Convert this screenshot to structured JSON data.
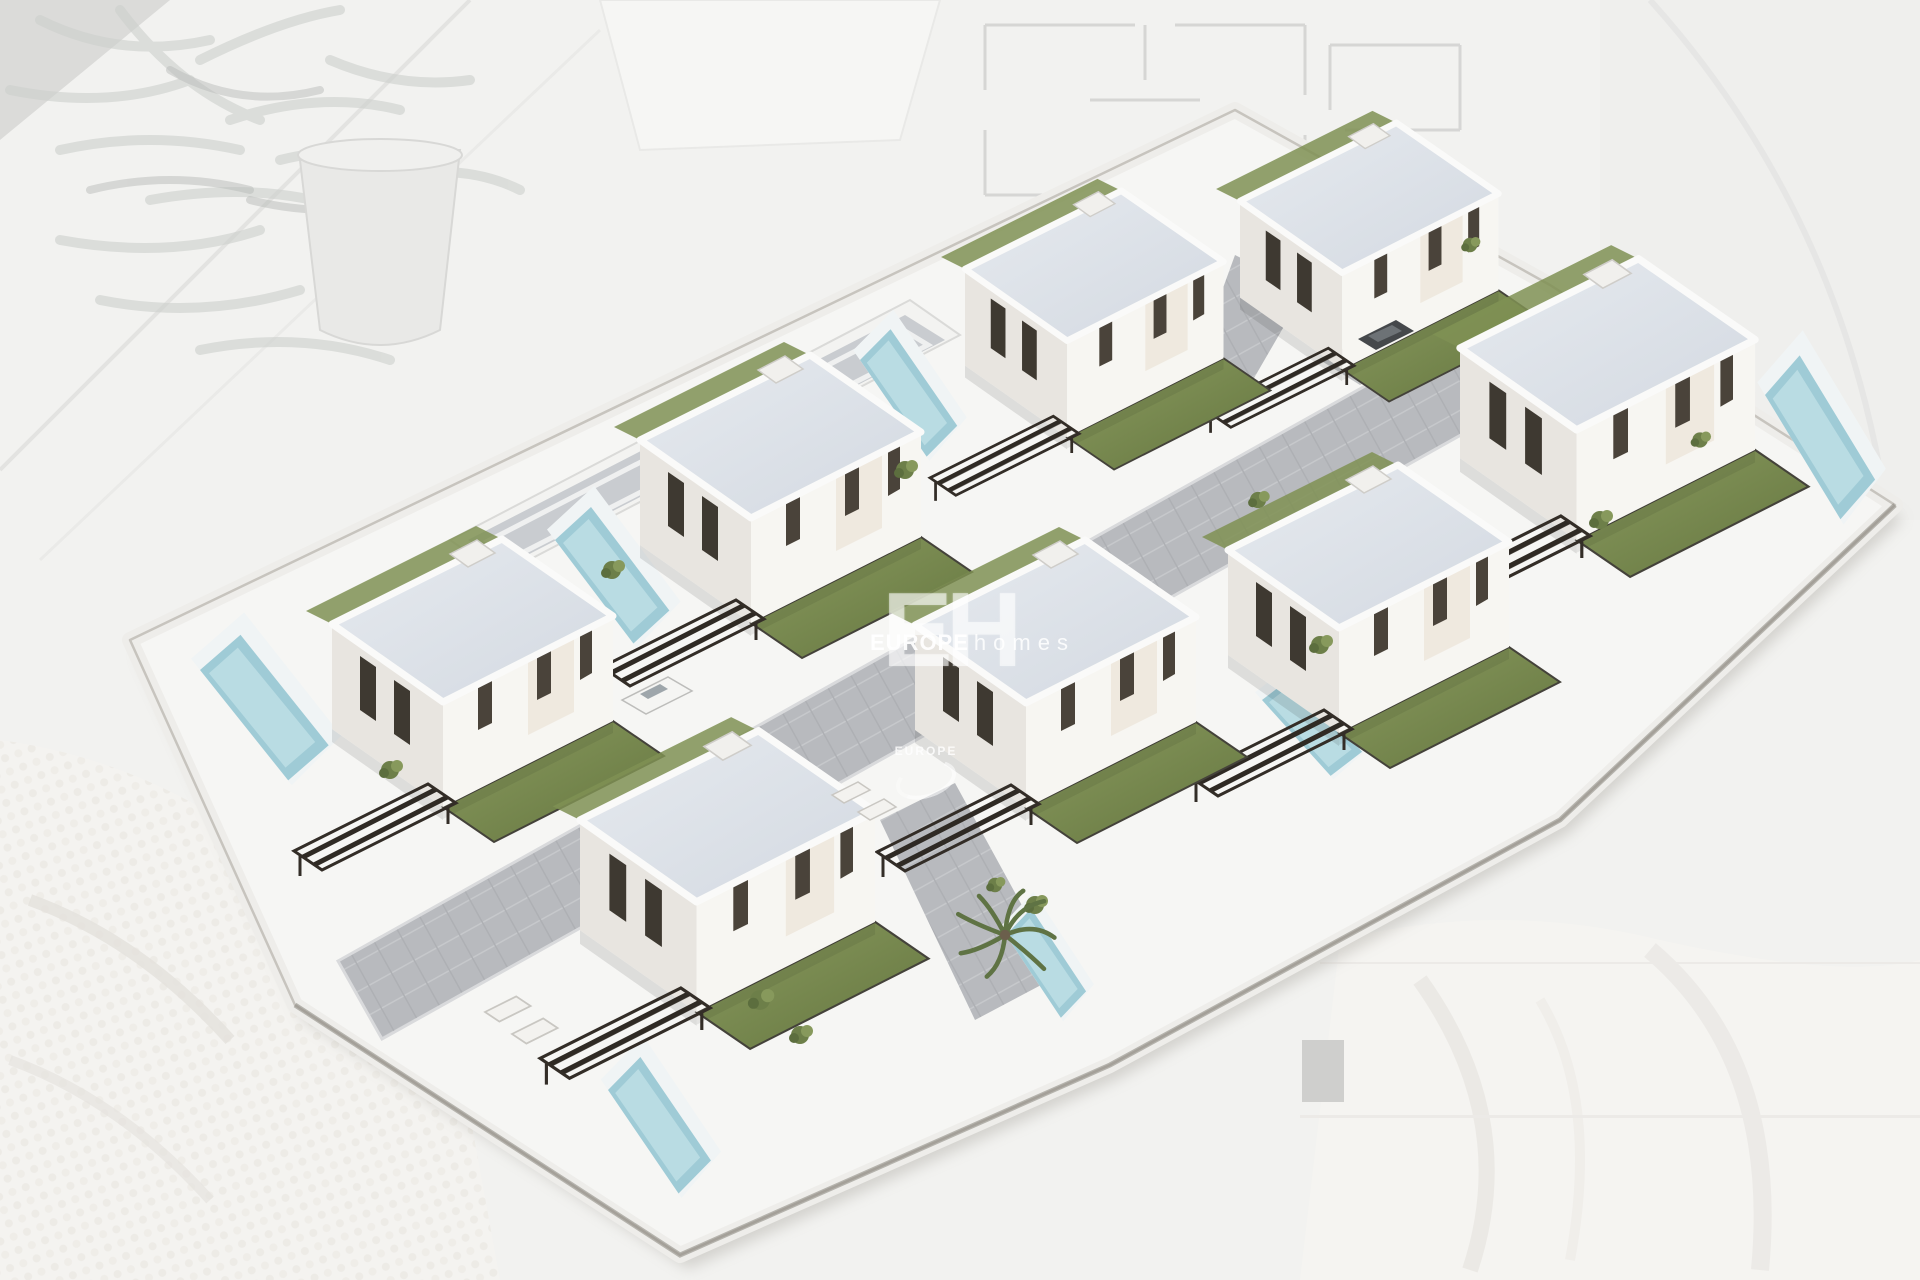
{
  "scene": {
    "type": "aerial-3d-architectural-render",
    "subject": "New-build residential development of detached modern white villas with private pools, lawns and dark pergolas, shown as a 3D site model over a faded architectural blueprint background",
    "villa_count": 8,
    "visible_pool_count": 7,
    "rows": 2,
    "background_elements": [
      "faded olive-branch plant in a pot (top-left)",
      "faded floor-plan drawings (top-right)",
      "white knitted blanket (bottom-left)",
      "soft white fabric (bottom-right)"
    ],
    "vehicles": [
      "white van on internal road",
      "dark car in driveway"
    ]
  },
  "watermark": {
    "initials": "EH",
    "brand_bold": "EUROPE",
    "brand_light": "homes"
  },
  "palette": {
    "background": "#f2f2f0",
    "wall_white": "#f7f6f2",
    "wall_shade": "#e8e5e0",
    "roof": "#dde2e8",
    "lawn_green": "#75874e",
    "pool_blue": "#9fcbd6",
    "pergola_dark": "#332d27",
    "road_grey": "#b8babe",
    "blueprint_line": "#d3d3d1",
    "watermark_white": "#ffffff"
  }
}
